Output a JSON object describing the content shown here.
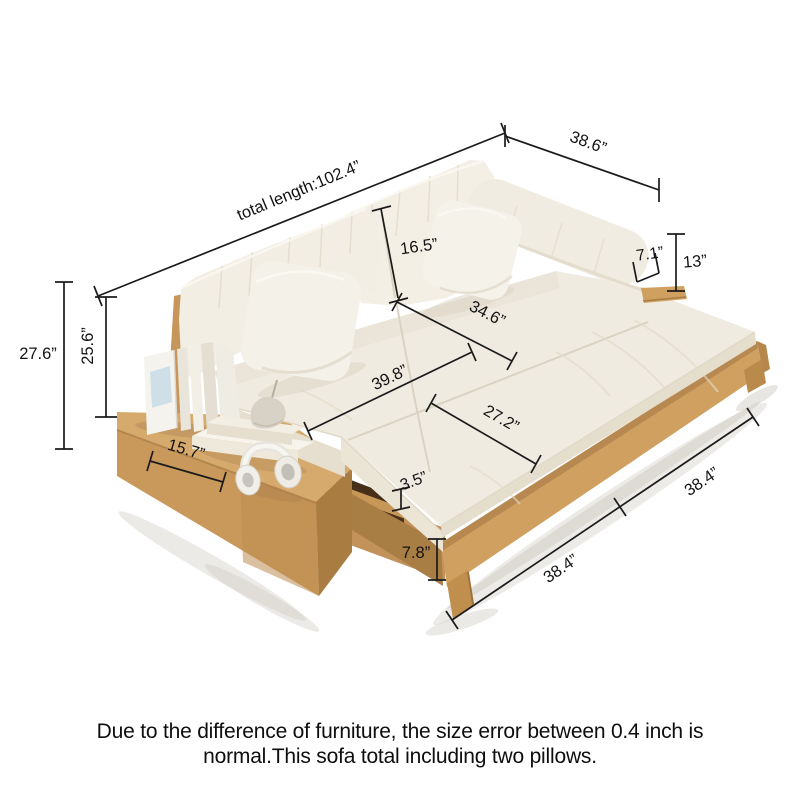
{
  "image": {
    "kind": "furniture dimension diagram",
    "subject": "wood-frame sofa bed with pull-out section, left side table, books and headphones",
    "background": "#ffffff"
  },
  "colors": {
    "dimension_line": "#1b1b1b",
    "label_text": "#131313",
    "wood_light": "#d6aa6d",
    "wood_mid": "#c9995c",
    "wood_dark": "#a97c42",
    "fabric": "#f0ebe0",
    "fabric_shadow": "#e5dfd0",
    "caption_text": "#0e0e0e"
  },
  "dims": {
    "total_length": "total length:102.4”",
    "overall_depth": "38.6”",
    "back_cushion_height": "16.5”",
    "armrest_top_width": "7.1”",
    "armrest_height": "13”",
    "seat_depth": "34.6”",
    "seat_length": "39.8”",
    "pullout_cushion_width": "27.2”",
    "cushion_thickness": "3.5”",
    "base_height": "7.8”",
    "front_left_section": "38.4”",
    "front_right_section": "38.4”",
    "side_table_length": "15.7”",
    "overall_height": "27.6”",
    "back_height": "25.6”"
  },
  "caption": {
    "line1": "Due to the difference of furniture, the size error between 0.4 inch is",
    "line2": "normal.This sofa total including two pillows."
  }
}
